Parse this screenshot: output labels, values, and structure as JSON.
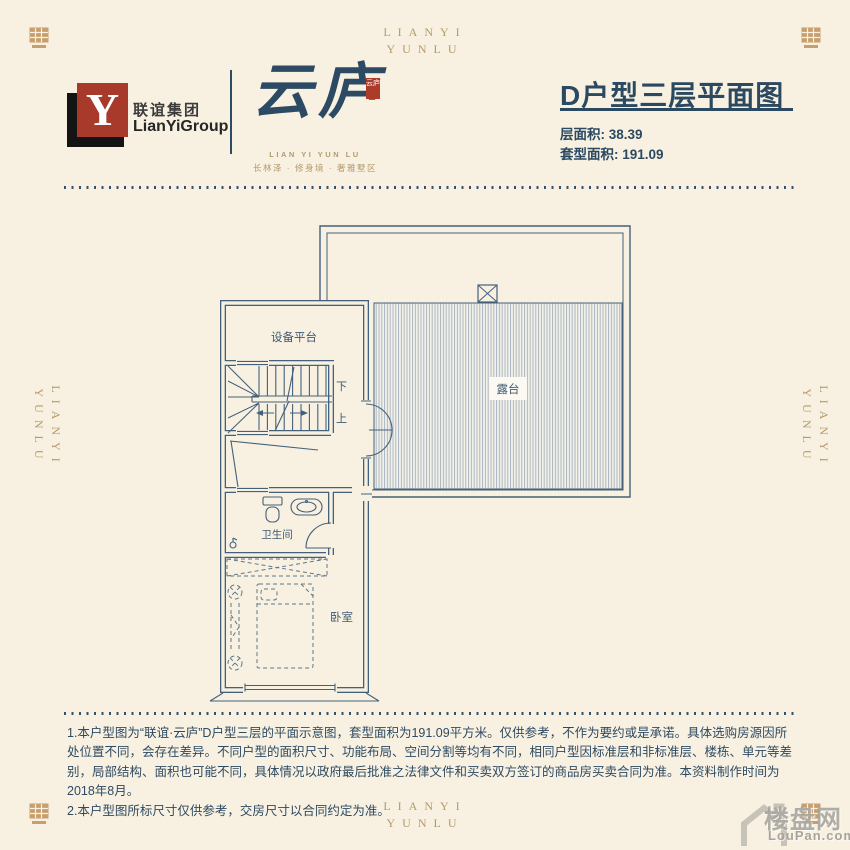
{
  "colors": {
    "background": "#f8f1e2",
    "accent": "#2b4960",
    "gold": "#b49a6a",
    "logo_red": "#a83a2b",
    "plan_line": "#44617b"
  },
  "frame": {
    "brand": {
      "line1": "LIANYI",
      "line2": "YUNLU"
    }
  },
  "header": {
    "group_logo": {
      "letter": "Y",
      "cn": "联谊集团",
      "en": "LianYiGroup"
    },
    "project_logo": {
      "name": "云庐",
      "seal_text": "云庐",
      "latin": "LIAN YI YUN LU",
      "tagline": "长林泽 · 修身境 · 奢雅墅区"
    },
    "title": "D户型三层平面图",
    "area_floor": "层面积: 38.39",
    "area_unit": "套型面积: 191.09"
  },
  "plan": {
    "labels": {
      "equipment": "设备平台",
      "terrace": "露台",
      "bath": "卫生间",
      "bedroom": "卧室",
      "down": "下",
      "up": "上"
    }
  },
  "notes": [
    "1.本户型图为“联谊·云庐”D户型三层的平面示意图，套型面积为191.09平方米。仅供参考，不作为要约或是承诺。具体选购房源因所处位置不同，会存在差异。不同户型的面积尺寸、功能布局、空间分割等均有不同，相同户型因标准层和非标准层、楼栋、单元等差别，局部结构、面积也可能不同，具体情况以政府最后批准之法律文件和买卖双方签订的商品房买卖合同为准。本资料制作时间为2018年8月。",
    "2.本户型图所标尺寸仅供参考，交房尺寸以合同约定为准。"
  ],
  "watermark": {
    "cn": "楼盘网",
    "en": "LouPan.com"
  }
}
